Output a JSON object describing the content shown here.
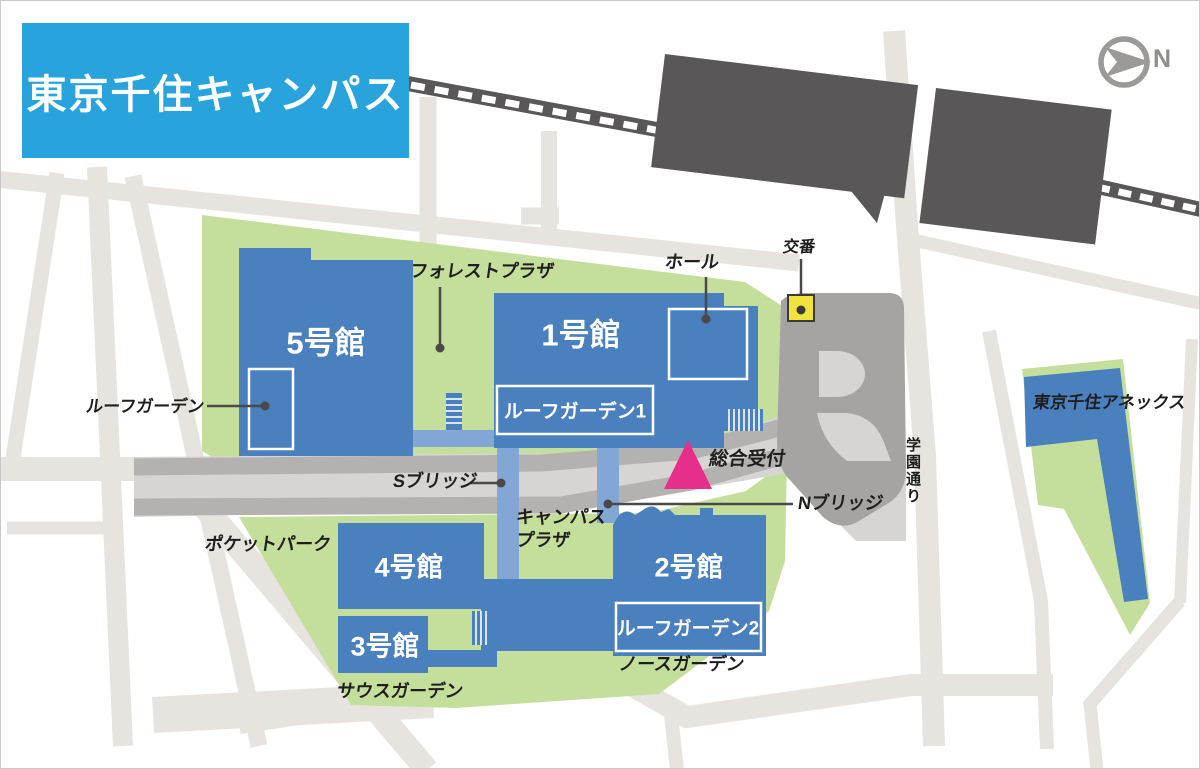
{
  "title": "東京千住キャンパス",
  "compass": {
    "north_label": "N"
  },
  "railway": {
    "station_main": "北千住駅",
    "station_east_exit": "東口（電大口）"
  },
  "buildings": {
    "b5": {
      "label": "5号館"
    },
    "b1": {
      "label": "1号館"
    },
    "b4": {
      "label": "4号館"
    },
    "b3": {
      "label": "3号館"
    },
    "b2": {
      "label": "2号館"
    },
    "annex": {
      "label": "東京千住アネックス"
    }
  },
  "roof_gardens": {
    "rg": "ルーフガーデン",
    "rg1": "ルーフガーデン1",
    "rg2": "ルーフガーデン2"
  },
  "labels": {
    "forest_plaza": "フォレストプラザ",
    "hall": "ホール",
    "koban": "交番",
    "reception": "総合受付",
    "s_bridge": "Sブリッジ",
    "n_bridge": "Nブリッジ",
    "campus_plaza_line1": "キャンパス",
    "campus_plaza_line2": "プラザ",
    "pocket_park": "ポケットパーク",
    "south_garden": "サウスガーデン",
    "north_garden": "ノースガーデン",
    "gakuen_dori": "学園通り"
  },
  "colors": {
    "title_blue": "#29a3dc",
    "building_blue": "#4b80be",
    "bridge_blue": "#82a7d4",
    "campus_green": "#c4df9c",
    "street_gray": "#e7e4e0",
    "road_base": "#d7d5d3",
    "road_band": "#b3b2b1",
    "rotary_gray": "#a5a4a3",
    "station_dark": "#5a5758",
    "koban_yellow": "#f2e23c",
    "reception_pink": "#e62e8b",
    "leader_line": "#4a4849",
    "label_text": "#1f1e1e"
  }
}
